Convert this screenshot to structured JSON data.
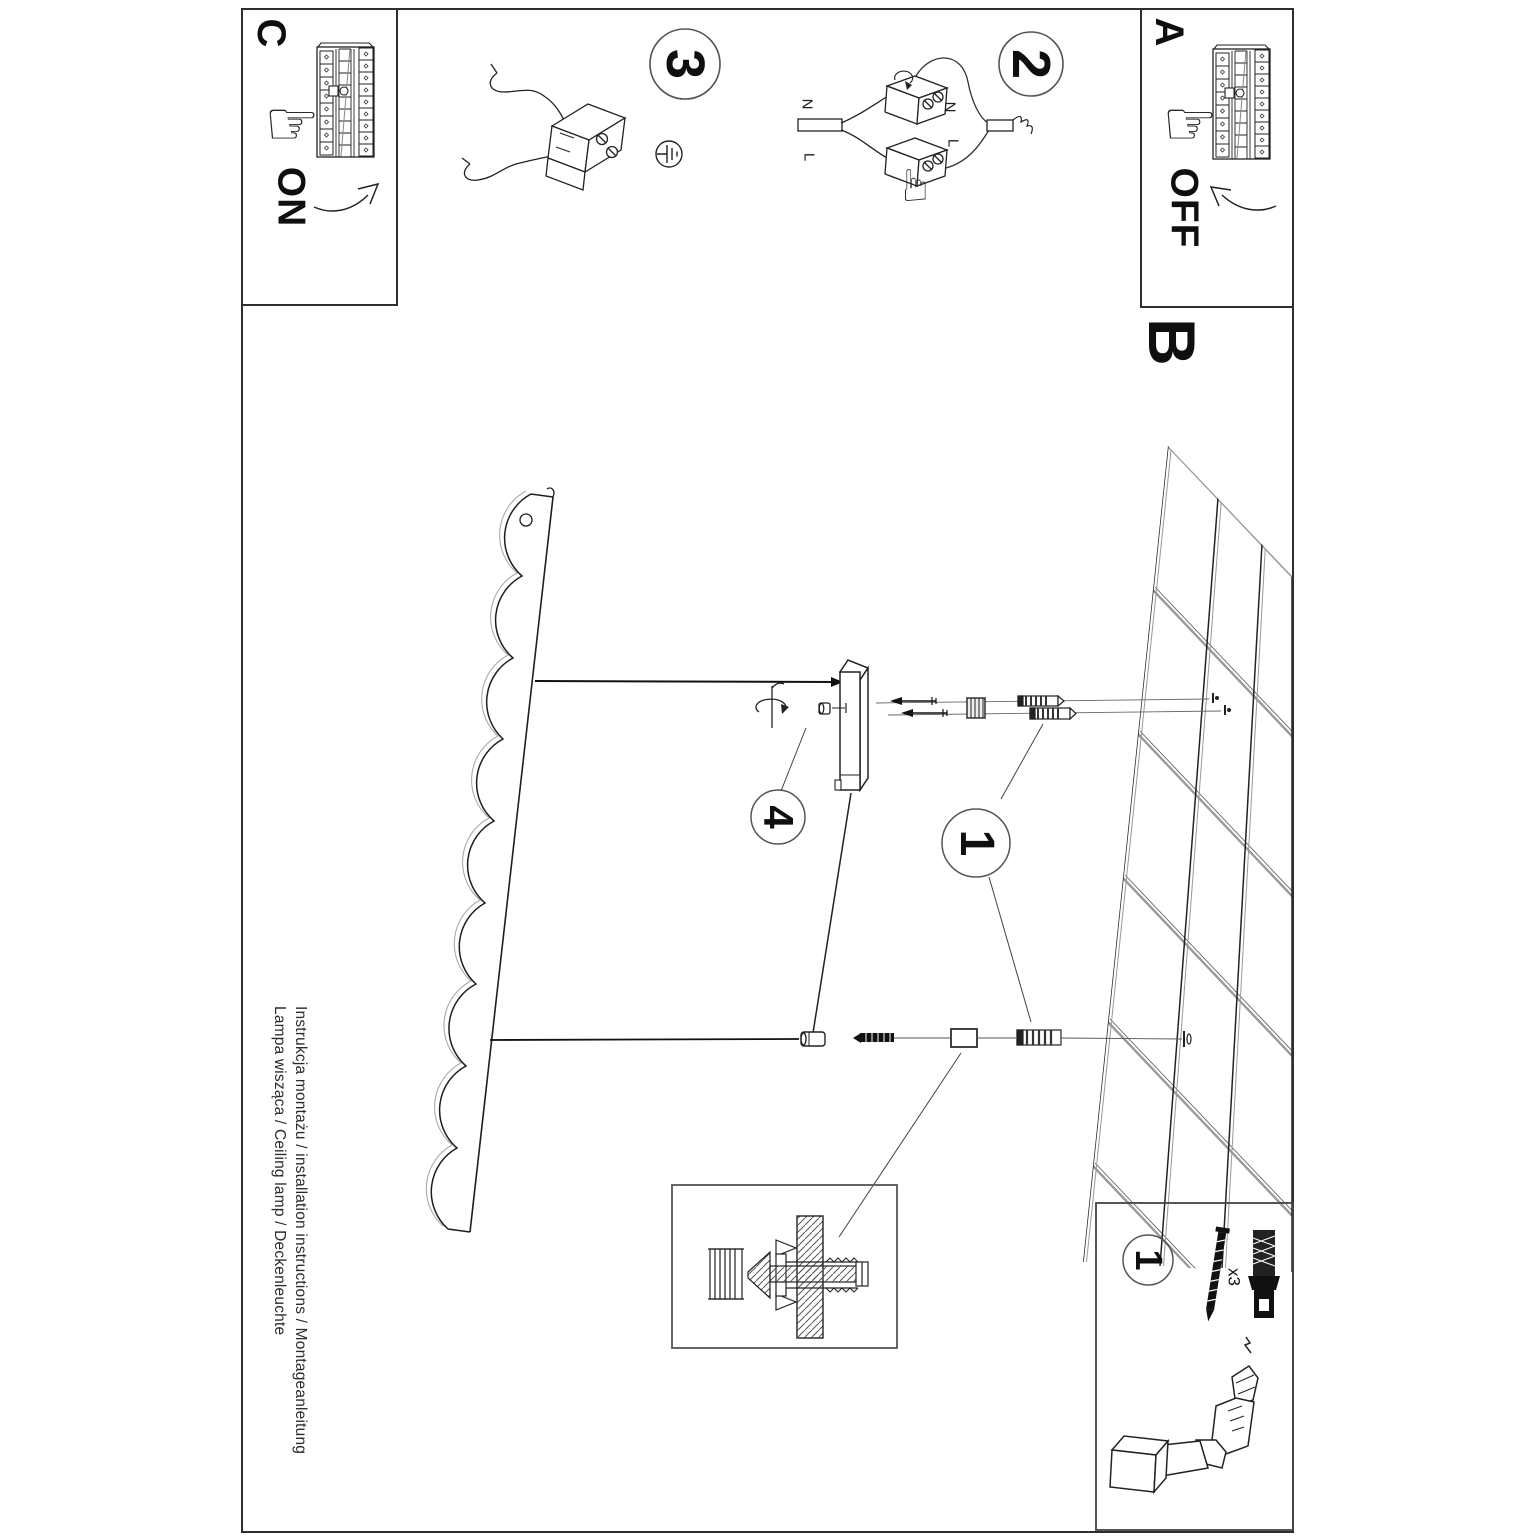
{
  "section_labels": {
    "a": "A",
    "b": "B",
    "c": "C"
  },
  "switch_states": {
    "on": "ON",
    "off": "OFF"
  },
  "step_numbers": {
    "step1": "1",
    "step2": "2",
    "step3": "3",
    "step4": "4",
    "hardware_kit": "1"
  },
  "wire_labels": {
    "supply_n": "N",
    "supply_l": "L",
    "connector_n": "N",
    "connector_l": "L"
  },
  "hardware": {
    "quantity": "x3"
  },
  "footer": {
    "instruction_line": "Instrukcja montażu / installation instructions / Montageanleitung",
    "product_line": "Lampa wisząca / Ceiling lamp / Deckenleuchte"
  },
  "icons": {
    "pointing_hand": "☞"
  },
  "colors": {
    "ink": "#1c1c1c",
    "line_gray": "#555555",
    "soft_gray": "#9a9a9a"
  }
}
